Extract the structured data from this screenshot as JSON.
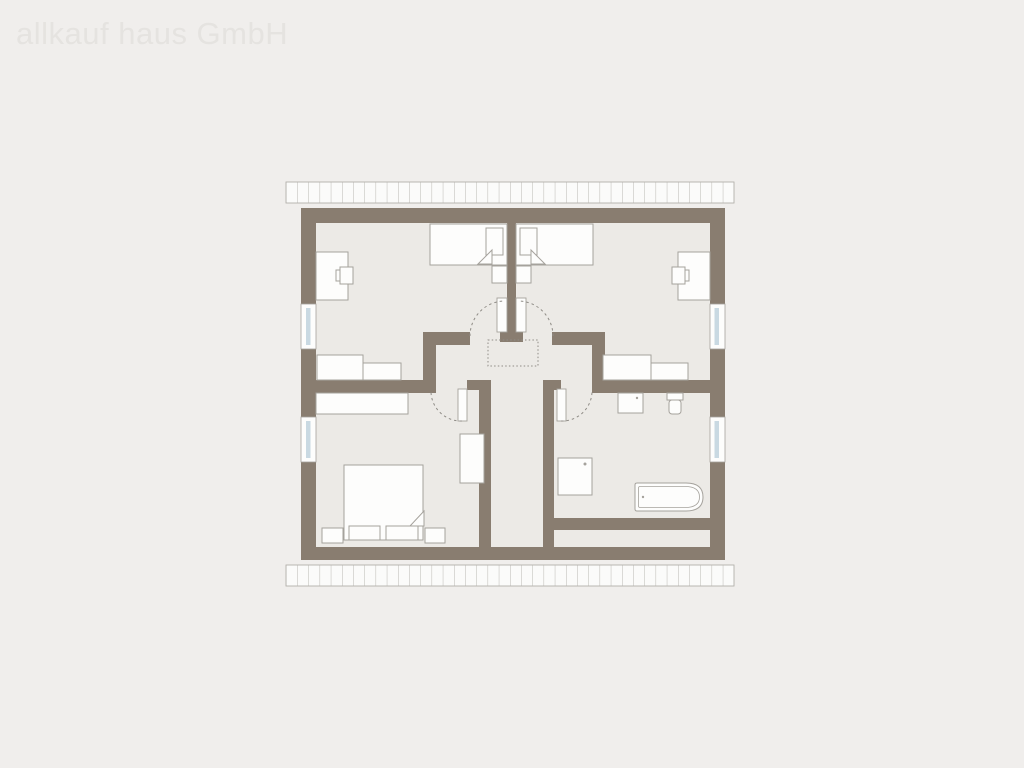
{
  "watermark": {
    "text": "allkauf haus GmbH"
  },
  "colors": {
    "bg": "#f0eeec",
    "floor": "#eceae6",
    "wall": "#897d70",
    "fixture_fill": "#fdfdfc",
    "fixture_stroke": "#a5a29c",
    "eave_fill": "#fbfbfa",
    "eave_stroke": "#b3b0ab",
    "glazing": "#c9d9e2",
    "annotation": "#8f8c86",
    "watermark": "#e5e3e0"
  },
  "plan": {
    "type": "floor-plan",
    "window_count": 4,
    "door_count": 4,
    "symbols": [
      "roof-eave-top",
      "roof-eave-bottom",
      "single-bed",
      "single-bed",
      "double-bed",
      "desk",
      "desk",
      "chair",
      "chair",
      "bedside-table",
      "bedside-table",
      "nightstand",
      "nightstand",
      "sideboard",
      "sideboard",
      "sideboard",
      "sideboard",
      "wardrobe",
      "tall-cabinet",
      "sink",
      "toilet",
      "shower",
      "bathtub",
      "ceiling-opening"
    ]
  }
}
